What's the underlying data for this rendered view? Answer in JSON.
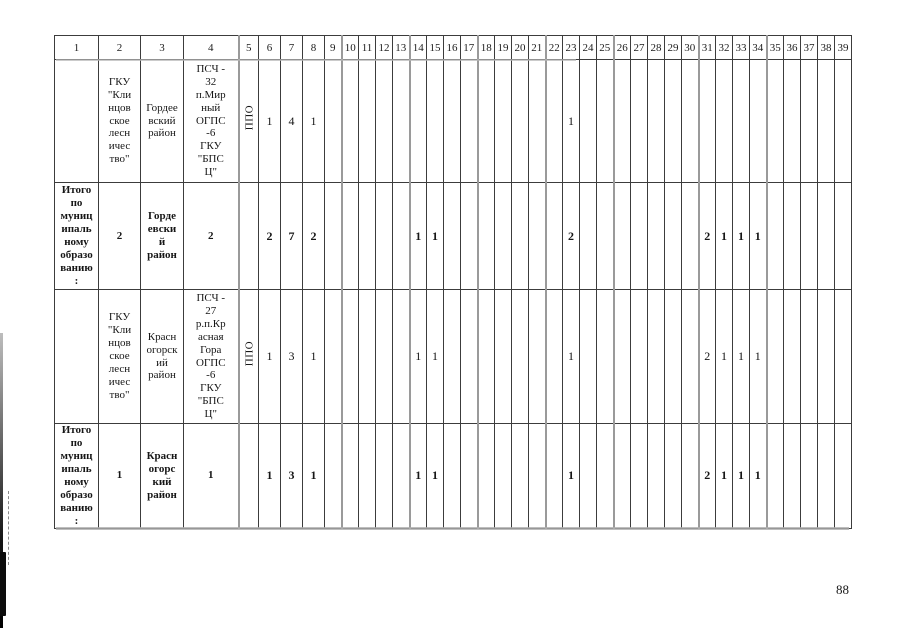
{
  "page": {
    "number": "88"
  },
  "table": {
    "columns": [
      "1",
      "2",
      "3",
      "4",
      "5",
      "6",
      "7",
      "8",
      "9",
      "10",
      "11",
      "12",
      "13",
      "14",
      "15",
      "16",
      "17",
      "18",
      "19",
      "20",
      "21",
      "22",
      "23",
      "24",
      "25",
      "26",
      "27",
      "28",
      "29",
      "30",
      "31",
      "32",
      "33",
      "34",
      "35",
      "36",
      "37",
      "38",
      "39"
    ],
    "rows": [
      {
        "bold": false,
        "cells": [
          "",
          "ГКУ\n\"Кли\nнцов\nское\nлесн\nичес\nтво\"",
          "Гордее\nвский\nрайон",
          "ПСЧ -\n32\nп.Мир\nный\nОГПС\n-6\nГКУ\n\"БПС\nЦ\"",
          "ППО",
          "1",
          "4",
          "1",
          "",
          "",
          "",
          "",
          "",
          "",
          "",
          "",
          "",
          "",
          "",
          "",
          "",
          "",
          "1",
          "",
          "",
          "",
          "",
          "",
          "",
          "",
          "",
          "",
          "",
          "",
          "",
          "",
          "",
          "",
          ""
        ]
      },
      {
        "bold": true,
        "cells": [
          "Итого\nпо\nмуниц\nипаль\nному\nобразо\nванию\n:",
          "2",
          "Горде\nевски\nй\nрайон",
          "2",
          "",
          "2",
          "7",
          "2",
          "",
          "",
          "",
          "",
          "",
          "1",
          "1",
          "",
          "",
          "",
          "",
          "",
          "",
          "",
          "2",
          "",
          "",
          "",
          "",
          "",
          "",
          "",
          "2",
          "1",
          "1",
          "1",
          "",
          "",
          "",
          "",
          ""
        ]
      },
      {
        "bold": false,
        "cells": [
          "",
          "ГКУ\n\"Кли\nнцов\nское\nлесн\nичес\nтво\"",
          "Красн\nогорск\nий\nрайон",
          "ПСЧ -\n27\nр.п.Кр\nасная\nГора\nОГПС\n-6\nГКУ\n\"БПС\nЦ\"",
          "ППО",
          "1",
          "3",
          "1",
          "",
          "",
          "",
          "",
          "",
          "1",
          "1",
          "",
          "",
          "",
          "",
          "",
          "",
          "",
          "1",
          "",
          "",
          "",
          "",
          "",
          "",
          "",
          "2",
          "1",
          "1",
          "1",
          "",
          "",
          "",
          "",
          ""
        ]
      },
      {
        "bold": true,
        "cells": [
          "Итого\nпо\nмуниц\nипаль\nному\nобразо\nванию\n:",
          "1",
          "Красн\nогорс\nкий\nрайон",
          "1",
          "",
          "1",
          "3",
          "1",
          "",
          "",
          "",
          "",
          "",
          "1",
          "1",
          "",
          "",
          "",
          "",
          "",
          "",
          "",
          "1",
          "",
          "",
          "",
          "",
          "",
          "",
          "",
          "2",
          "1",
          "1",
          "1",
          "",
          "",
          "",
          "",
          ""
        ]
      }
    ]
  }
}
